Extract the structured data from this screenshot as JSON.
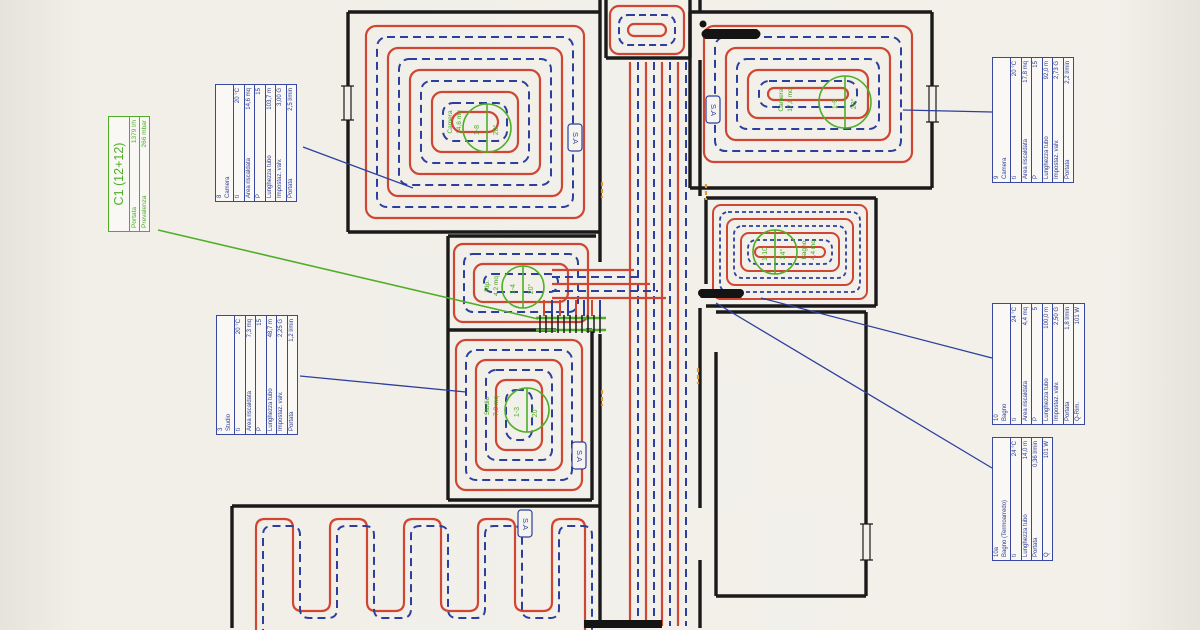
{
  "plan": {
    "collector": {
      "title": "C1 (12+12)",
      "rows": [
        [
          "Portata",
          "1379 l/h"
        ],
        [
          "Prevalenza",
          "266 mbar"
        ]
      ]
    },
    "sa_label": "S.A",
    "tables": [
      {
        "id": "8",
        "room": "Camera",
        "rows": [
          [
            "ti",
            "20 °C"
          ],
          [
            "Area riscaldata",
            "14,6 mq"
          ],
          [
            "P",
            "15"
          ],
          [
            "Lunghezza tubo",
            "103,7 m"
          ],
          [
            "Impostaz. valv.",
            "3,00 G"
          ],
          [
            "Portata",
            "2,5 l/min"
          ]
        ]
      },
      {
        "id": "9",
        "room": "Camera",
        "rows": [
          [
            "ti",
            "20 °C"
          ],
          [
            "Area riscaldata",
            "17,8 mq"
          ],
          [
            "P",
            "15"
          ],
          [
            "Lunghezza tubo",
            "92,0 m"
          ],
          [
            "Impostaz. valv.",
            "2,73 G"
          ],
          [
            "Portata",
            "2,2 l/min"
          ]
        ]
      },
      {
        "id": "3",
        "room": "Studio",
        "rows": [
          [
            "ti",
            "20 °C"
          ],
          [
            "Area riscaldata",
            "7,3 mq"
          ],
          [
            "P",
            "15"
          ],
          [
            "Lunghezza tubo",
            "48,7 m"
          ],
          [
            "Impostaz. valv.",
            "2,25 G"
          ],
          [
            "Portata",
            "1,2 l/min"
          ]
        ]
      },
      {
        "id": "10",
        "room": "Bagno",
        "rows": [
          [
            "ti",
            "24 °C"
          ],
          [
            "Area riscaldata",
            "4,4 mq"
          ],
          [
            "P",
            "5"
          ],
          [
            "Lunghezza tubo",
            "100,0 m"
          ],
          [
            "Impostaz. valv.",
            "2,50 G"
          ],
          [
            "Portata",
            "1,8 l/min"
          ],
          [
            "Q-Rim.",
            "101 W"
          ]
        ]
      },
      {
        "id": "10a",
        "room": "Bagno (Termoarredo)",
        "rows": [
          [
            "ti",
            "24 °C"
          ],
          [
            "Lunghezza tubo",
            "14,0 m"
          ],
          [
            "Portata",
            "0,36 l/min"
          ],
          [
            "Q",
            "101 W"
          ]
        ]
      }
    ],
    "markers": [
      {
        "circuit": "1-8",
        "temp": "20°",
        "room": "Camera",
        "area": "14,6 mq"
      },
      {
        "circuit": "1-9",
        "temp": "20°",
        "room": "Camera",
        "area": "17,8 mq"
      },
      {
        "circuit": "1-10",
        "temp": "24°",
        "room": "Bagno",
        "area": "4,4 mq"
      },
      {
        "circuit": "1-4",
        "temp": "20°",
        "room": "Rip.",
        "area": "4,2 mq"
      },
      {
        "circuit": "1-3",
        "temp": "20°",
        "room": "Studio",
        "area": "7,3 mq"
      }
    ],
    "colors": {
      "pipe_red": "#cf4632",
      "pipe_blue": "#2c3f9e",
      "annotation_blue": "#3949a0",
      "annotation_green": "#4fae28",
      "wall_black": "#1a1a1a",
      "joint_orange": "#e09a30"
    }
  }
}
